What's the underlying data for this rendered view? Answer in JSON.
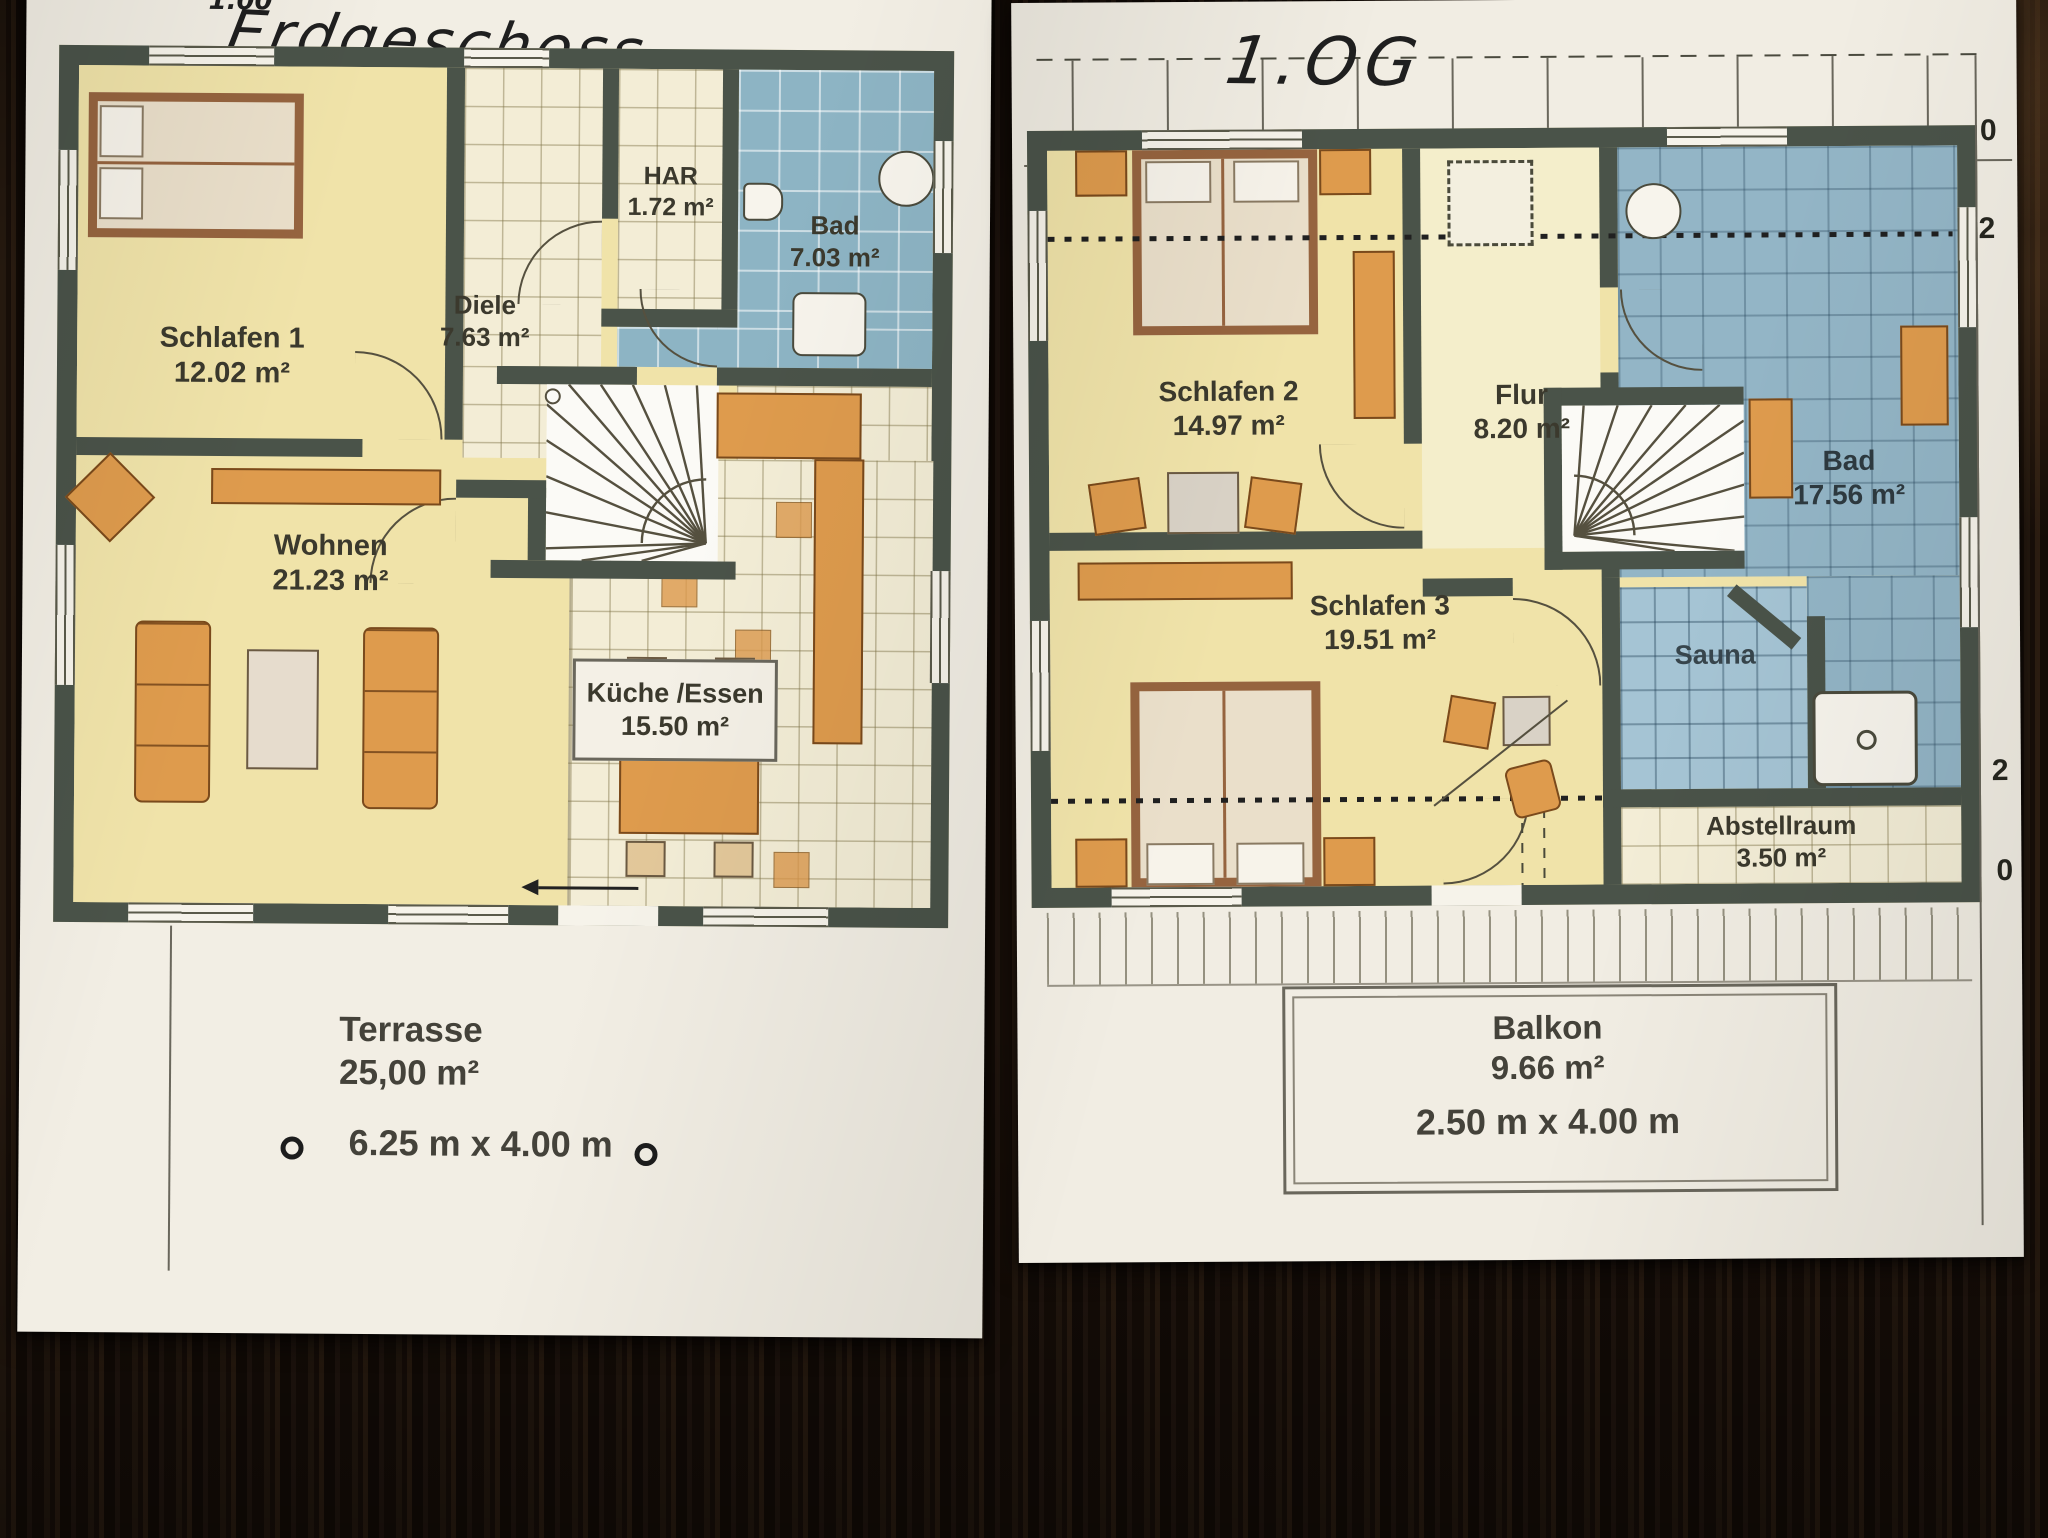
{
  "floors": {
    "eg": {
      "handwritten_note": "1.00",
      "handwritten_title": "Erdgeschoss",
      "rooms": {
        "schlafen1": {
          "name": "Schlafen 1",
          "area": "12.02 m²"
        },
        "diele": {
          "name": "Diele",
          "area": "7.63 m²"
        },
        "har": {
          "name": "HAR",
          "area": "1.72 m²"
        },
        "bad": {
          "name": "Bad",
          "area": "7.03 m²"
        },
        "wohnen": {
          "name": "Wohnen",
          "area": "21.23 m²"
        },
        "kueche": {
          "name": "Küche /Essen",
          "area": "15.50 m²"
        }
      },
      "terrasse": {
        "name": "Terrasse",
        "area": "25,00 m²",
        "dimensions": "6.25 m x 4.00 m"
      }
    },
    "og": {
      "handwritten_title": "1.OG",
      "rooms": {
        "schlafen2": {
          "name": "Schlafen 2",
          "area": "14.97 m²"
        },
        "flur": {
          "name": "Flur",
          "area": "8.20 m²"
        },
        "bad": {
          "name": "Bad",
          "area": "17.56 m²"
        },
        "schlafen3": {
          "name": "Schlafen 3",
          "area": "19.51 m²"
        },
        "sauna": {
          "name": "Sauna"
        },
        "abstellraum": {
          "name": "Abstellraum",
          "area": "3.50 m²"
        }
      },
      "balkon": {
        "name": "Balkon",
        "area": "9.66 m²",
        "dimensions": "2.50 m x 4.00 m"
      },
      "edge_numbers": [
        "0",
        "2",
        "2",
        "0"
      ]
    }
  },
  "colors": {
    "wall": "#4a5349",
    "paper": "#f2eee4",
    "bedroom_yellow": "#f0e3a9",
    "tile_cream": "#f3edd6",
    "tile_blue_eg": "#8db4c4",
    "tile_blue_og": "#93b5c6",
    "sauna_blue": "#a5c4d4",
    "accent_orange": "#de9b4d",
    "wood_table": "#1b120b"
  }
}
